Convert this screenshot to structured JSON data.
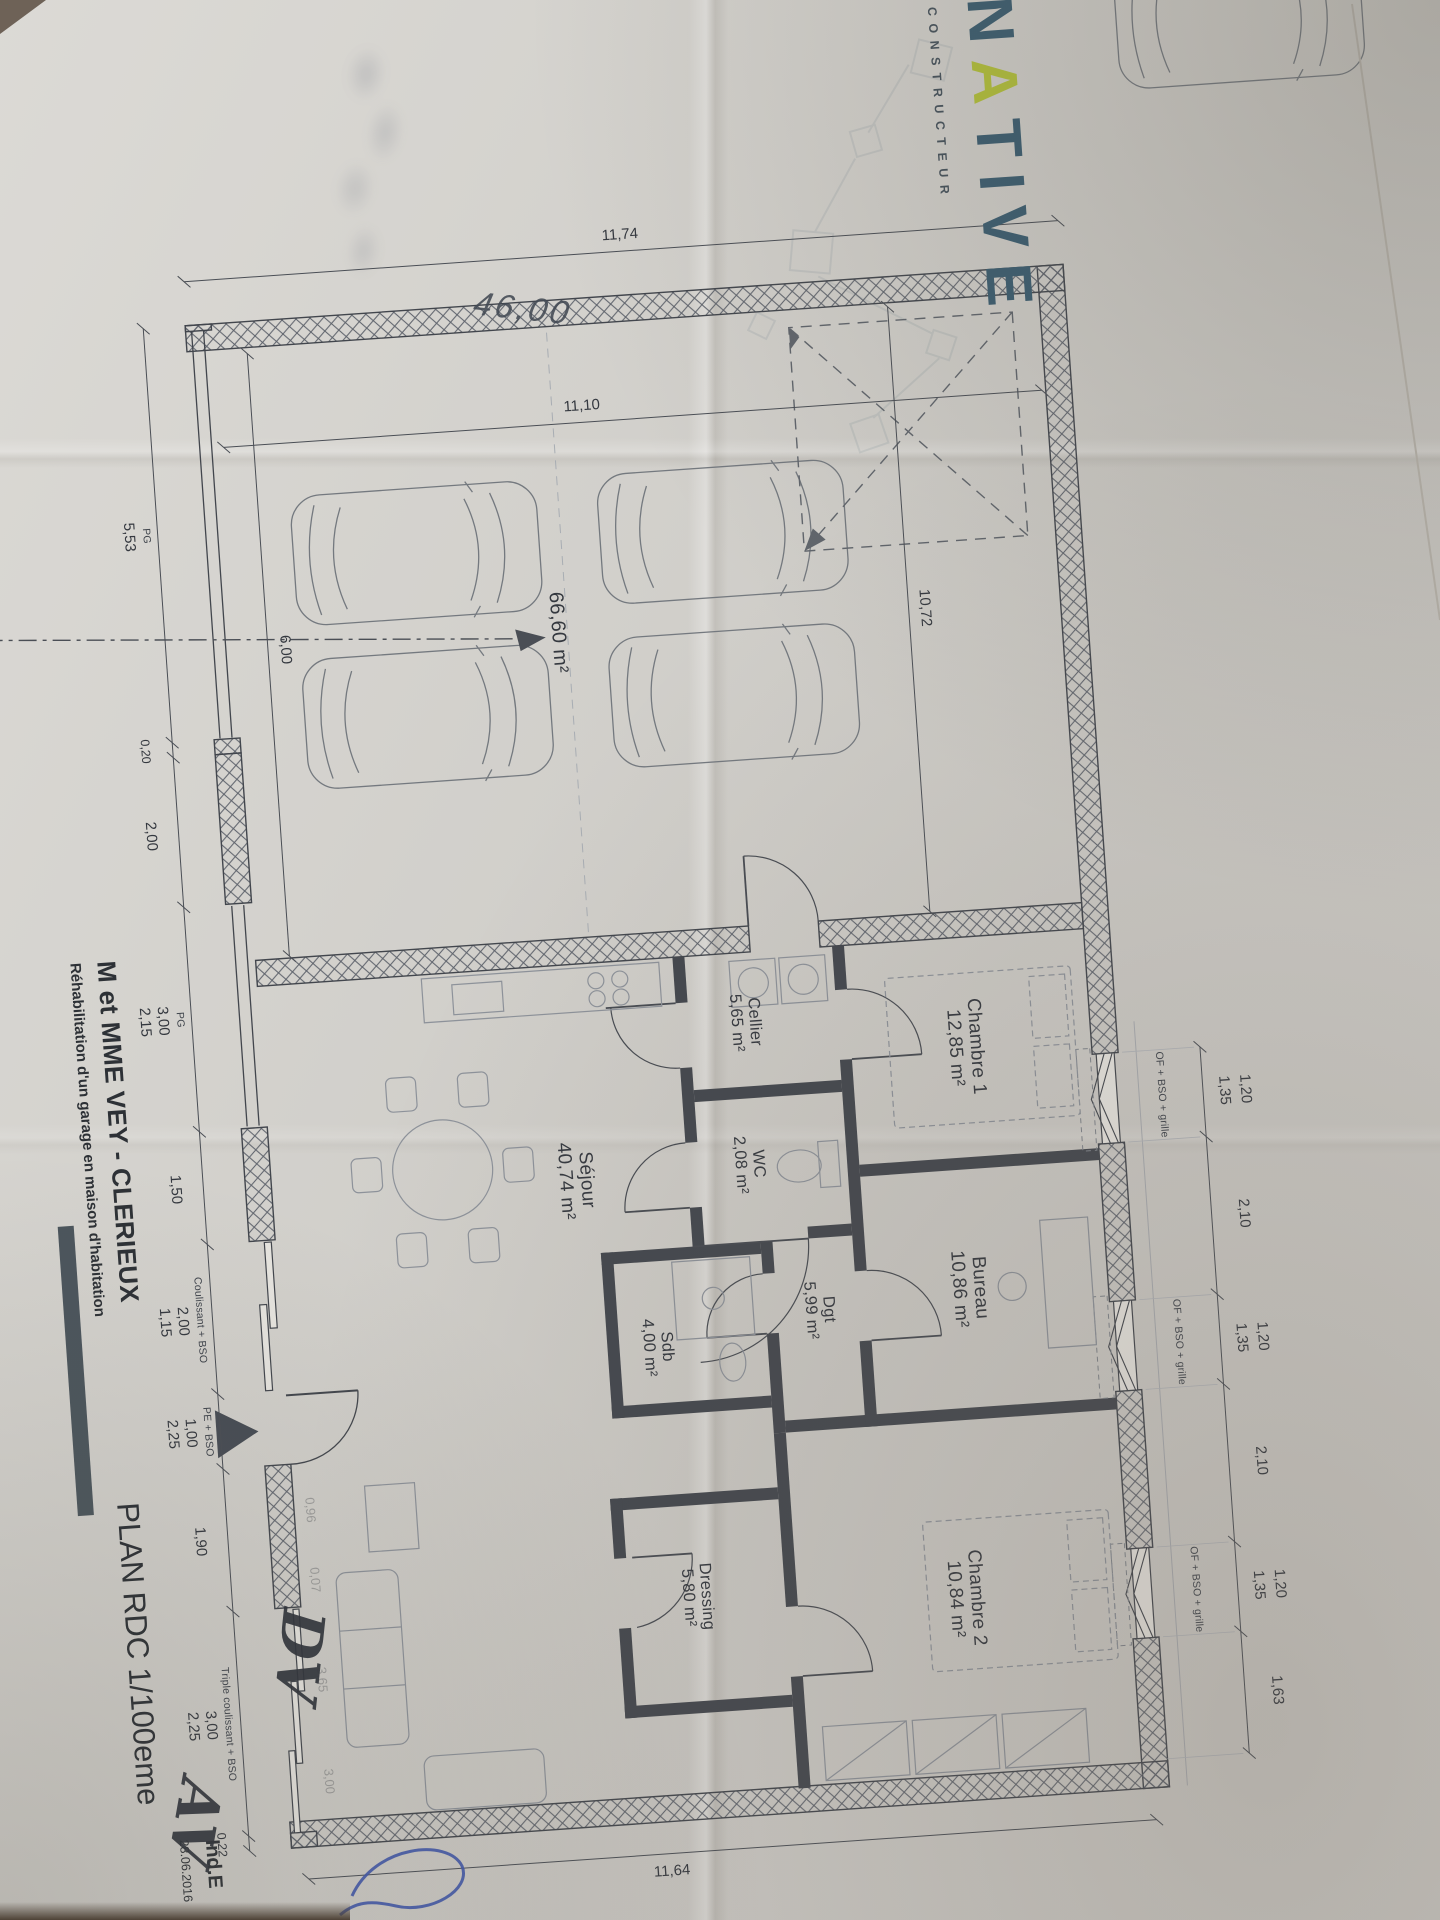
{
  "colors": {
    "paper": "#d8d6d1",
    "ink": "#3c4047",
    "logo_blue": "#3b5d70",
    "logo_green": "#b2c03a",
    "pen_blue": "#3f57ab"
  },
  "logo": {
    "letters": [
      "N",
      "A",
      "T",
      "I",
      "V",
      "E"
    ],
    "subtitle": "CONSTRUCTEUR"
  },
  "title_block": {
    "client": "M et MME VEY - CLERIEUX",
    "project": "Réhabilitation d'un garage en maison d'habitation",
    "plan_title": "PLAN RDC 1/100eme",
    "index_label": "Ind.E",
    "date": "28.06.2016"
  },
  "rooms": [
    {
      "name": "Chambre 1",
      "area": "12,85 m²"
    },
    {
      "name": "Bureau",
      "area": "10,86 m²"
    },
    {
      "name": "Chambre 2",
      "area": "10,84 m²"
    },
    {
      "name": "Cellier",
      "area": "5,65 m²"
    },
    {
      "name": "WC",
      "area": "2,08 m²"
    },
    {
      "name": "Dgt",
      "area": "5,99 m²"
    },
    {
      "name": "Sdb",
      "area": "4,00 m²"
    },
    {
      "name": "Dressing",
      "area": "5,80 m²"
    },
    {
      "name": "Séjour",
      "area": "40,74 m²"
    }
  ],
  "garage": {
    "area": "66,60 m²",
    "width_dim": "10,72",
    "depth_dim": "11,10",
    "inner_dim": "6,00",
    "handwritten_dim": "46,00"
  },
  "dims": {
    "left_total": "11,74",
    "right_total": "11,64",
    "win_w": "1,20",
    "win_h": "1,35",
    "win_gap": "2,10",
    "top_end": "1,63",
    "bottom": {
      "pg": "PG",
      "pg1_w": "5,53",
      "pier": "0,20",
      "wall1": "2,00",
      "pg2_w": "3,00",
      "pg2_h": "2,15",
      "wall2": "1,50",
      "coul": "Coulissant + BSO",
      "coul_w": "2,00",
      "coul_h": "1,15",
      "pe": "PE + BSO",
      "pe_w": "1,00",
      "pe_h": "2,25",
      "wall3": "1,90",
      "triple": "Triple coulissant + BSO",
      "triple_w": "3,00",
      "triple_h": "2,25",
      "end": "0,22"
    },
    "faint": [
      "0,96",
      "0,07",
      "3,65",
      "3,00"
    ]
  },
  "openings": {
    "window_label": "OF + BSO + grille"
  },
  "annotations": {
    "note1": "DV",
    "note2": "AV"
  }
}
